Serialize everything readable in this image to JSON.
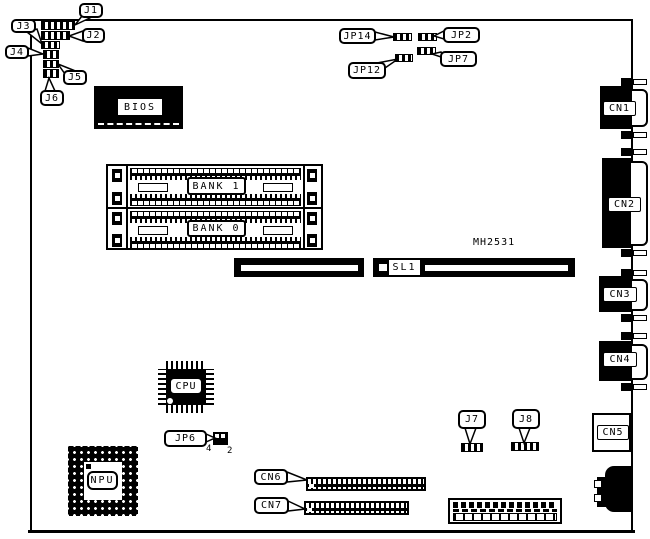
{
  "colors": {
    "fg": "#000000",
    "bg": "#ffffff"
  },
  "labels": {
    "j1": "J1",
    "j2": "J2",
    "j3": "J3",
    "j4": "J4",
    "j5": "J5",
    "j6": "J6",
    "j7": "J7",
    "j8": "J8",
    "jp2": "JP2",
    "jp6": "JP6",
    "jp7": "JP7",
    "jp12": "JP12",
    "jp14": "JP14",
    "cn6": "CN6",
    "cn7": "CN7"
  },
  "components": {
    "bios": "BIOS",
    "bank1": "BANK 1",
    "bank0": "BANK 0",
    "cpu": "CPU",
    "npu": "NPU",
    "sl1": "SL1",
    "cn1": "CN1",
    "cn2": "CN2",
    "cn3": "CN3",
    "cn4": "CN4",
    "cn5": "CN5",
    "part_number": "MH2531"
  },
  "jp6_pins": {
    "pin4": "4",
    "pin2": "2"
  }
}
